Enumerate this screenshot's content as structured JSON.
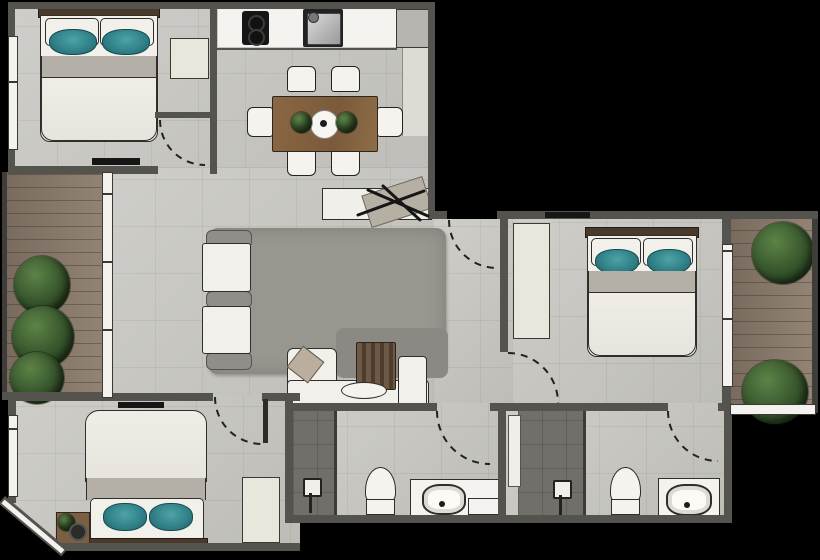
{
  "scene": {
    "type": "floor-plan",
    "description": "Top-down 3D rendered apartment floor plan on a black background; no text labels are present in the image",
    "text_labels": []
  },
  "palette": {
    "background": "#000000",
    "wall": "#55534d",
    "floor_tile": "#c9c8c3",
    "wood_deck": "#8d7d6e",
    "rug": "#98978f",
    "furniture_white": "#f1f0ea",
    "wardrobe_cream": "#e9e7dc",
    "pillow_teal": "#2f8086",
    "table_wood": "#8a6744",
    "plant_green": "#3c5c30",
    "blanket_taupe": "#b5b0a7",
    "fixture_dark": "#161616",
    "shower_tile": "#716f69",
    "headboard_wood": "#4a3a2c",
    "glass_white": "#f3f2ee",
    "steel": "#b9b9b9"
  },
  "rooms": [
    {
      "name": "bedroom-top-left",
      "furniture": [
        "double-bed-teal-pillows",
        "wardrobe",
        "tv-console",
        "window-left",
        "door-swing"
      ]
    },
    {
      "name": "kitchen-dining",
      "furniture": [
        "counter",
        "cooktop",
        "sink",
        "fridge",
        "dining-table-6-chairs",
        "centerpiece-plate",
        "table-plants",
        "sideboard-with-decor"
      ]
    },
    {
      "name": "living-room",
      "furniture": [
        "area-rug",
        "armchair-1",
        "armchair-2",
        "corner-sofa",
        "throw-pillow",
        "throw-blanket",
        "coffee-table",
        "media-bench"
      ]
    },
    {
      "name": "entry-hall",
      "furniture": [
        "entry-door-swing"
      ]
    },
    {
      "name": "bedroom-right",
      "furniture": [
        "double-bed-teal-pillows",
        "wardrobe",
        "tv-on-wall",
        "glass-door-to-balcony",
        "door-swing"
      ]
    },
    {
      "name": "balcony-left",
      "furniture": [
        "wood-deck",
        "shrubs",
        "glass-wall"
      ]
    },
    {
      "name": "balcony-right",
      "furniture": [
        "wood-deck",
        "shrub-top",
        "shrub-bottom",
        "glass-wall"
      ]
    },
    {
      "name": "bedroom-bottom-left",
      "furniture": [
        "double-bed-teal-pillows",
        "wardrobe",
        "nightstand-with-plant",
        "tv-on-wall",
        "angled-corner-window",
        "door-swing"
      ]
    },
    {
      "name": "bathroom-middle",
      "furniture": [
        "walk-in-shower",
        "shower-fixture",
        "toilet",
        "vanity-sink",
        "door-swing"
      ]
    },
    {
      "name": "bathroom-right",
      "furniture": [
        "walk-in-shower",
        "shower-fixture",
        "toilet",
        "vanity-sink",
        "door-swing"
      ]
    }
  ]
}
